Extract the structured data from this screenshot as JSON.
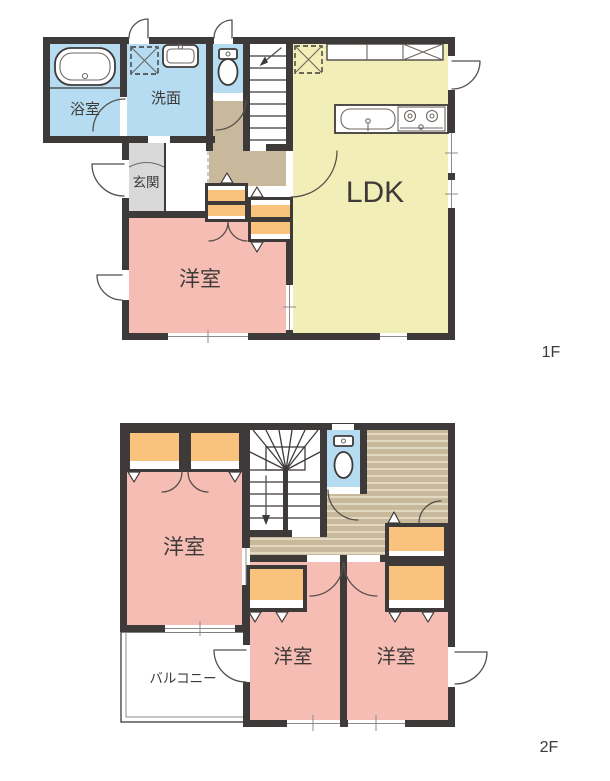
{
  "floors": {
    "f1": {
      "label": "1F",
      "rooms": {
        "bathroom": "浴室",
        "washroom": "洗面",
        "entrance": "玄関",
        "bedroom": "洋室",
        "ldk": "LDK"
      }
    },
    "f2": {
      "label": "2F",
      "rooms": {
        "bedroom_left": "洋室",
        "bedroom_center": "洋室",
        "bedroom_right": "洋室",
        "balcony": "バルコニー"
      }
    }
  },
  "colors": {
    "wall": "#3e3a39",
    "wet_blue": "#b5dcf1",
    "pink": "#f5bdb4",
    "yellow": "#f2eeb8",
    "orange": "#f9c37e",
    "tan": "#c8b99c",
    "gray": "#d9d9d9",
    "wood_stripe": "#ece4cb"
  }
}
